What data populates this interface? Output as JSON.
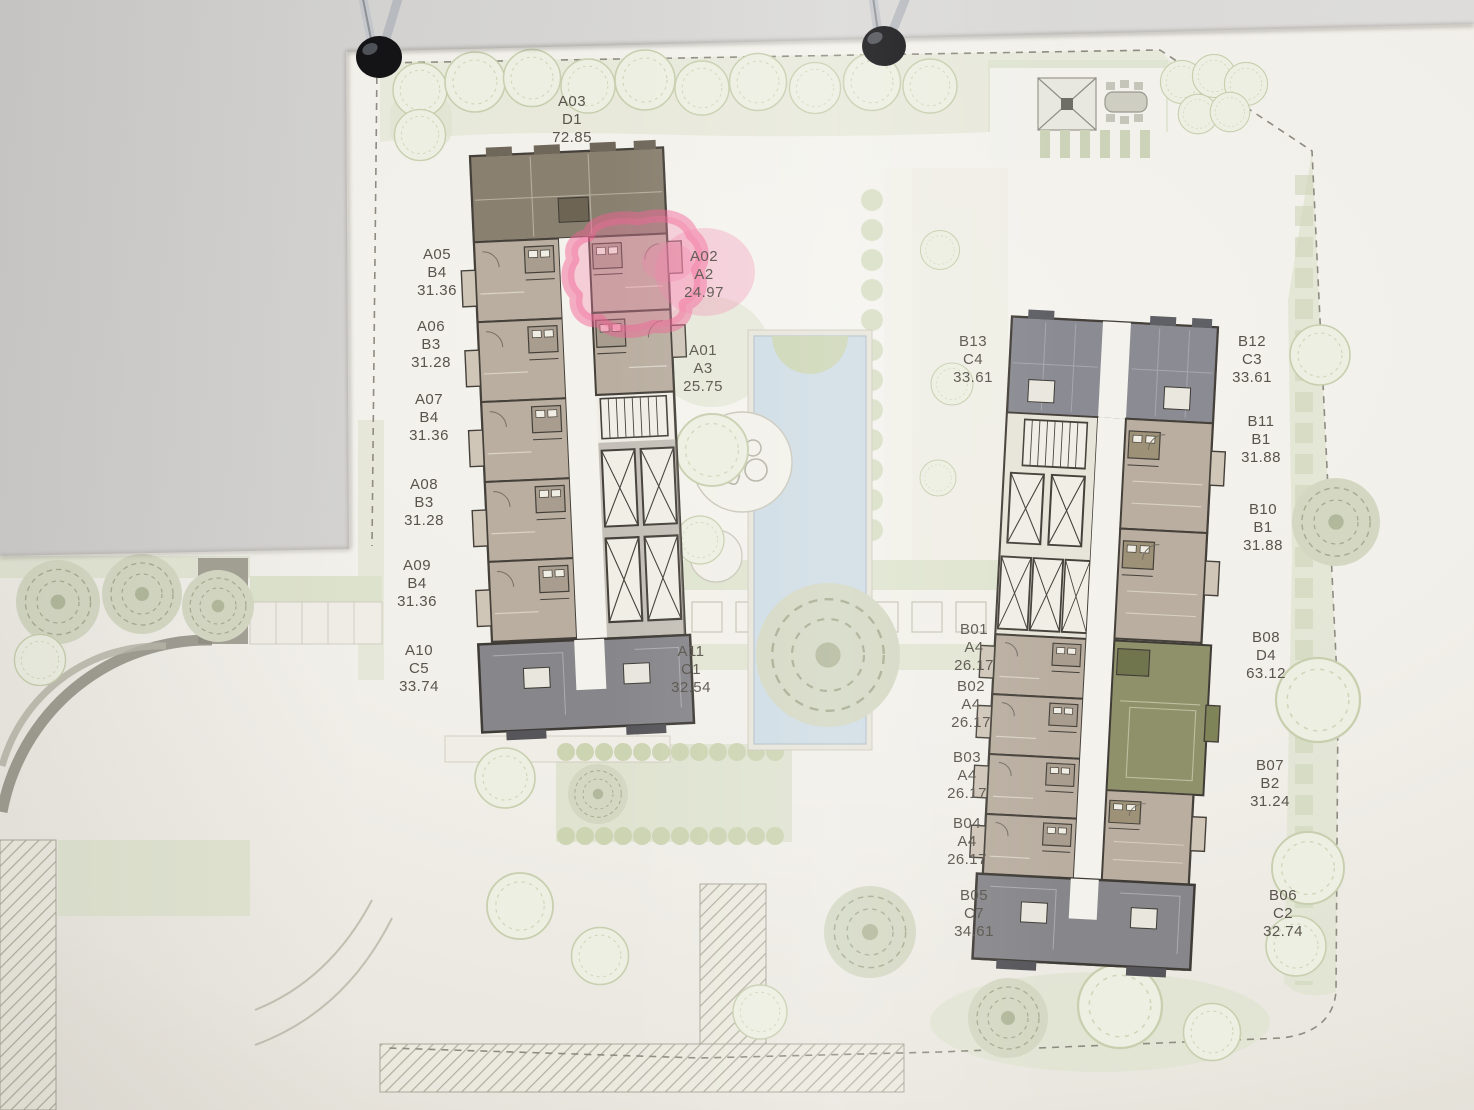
{
  "scene": {
    "binder_clip_count": 2
  },
  "towers": {
    "a": {
      "units": [
        {
          "id": "A03",
          "type": "D1",
          "area": "72.85"
        },
        {
          "id": "A05",
          "type": "B4",
          "area": "31.36"
        },
        {
          "id": "A06",
          "type": "B3",
          "area": "31.28"
        },
        {
          "id": "A07",
          "type": "B4",
          "area": "31.36"
        },
        {
          "id": "A08",
          "type": "B3",
          "area": "31.28"
        },
        {
          "id": "A09",
          "type": "B4",
          "area": "31.36"
        },
        {
          "id": "A10",
          "type": "C5",
          "area": "33.74"
        },
        {
          "id": "A02",
          "type": "A2",
          "area": "24.97",
          "highlighted": true
        },
        {
          "id": "A01",
          "type": "A3",
          "area": "25.75"
        },
        {
          "id": "A11",
          "type": "C1",
          "area": "32.54"
        }
      ]
    },
    "b": {
      "units": [
        {
          "id": "B13",
          "type": "C4",
          "area": "33.61"
        },
        {
          "id": "B12",
          "type": "C3",
          "area": "33.61"
        },
        {
          "id": "B11",
          "type": "B1",
          "area": "31.88"
        },
        {
          "id": "B10",
          "type": "B1",
          "area": "31.88"
        },
        {
          "id": "B01",
          "type": "A4",
          "area": "26.17"
        },
        {
          "id": "B02",
          "type": "A4",
          "area": "26.17"
        },
        {
          "id": "B03",
          "type": "A4",
          "area": "26.17"
        },
        {
          "id": "B04",
          "type": "A4",
          "area": "26.17"
        },
        {
          "id": "B05",
          "type": "C7",
          "area": "34.61"
        },
        {
          "id": "B08",
          "type": "D4",
          "area": "63.12"
        },
        {
          "id": "B07",
          "type": "B2",
          "area": "31.24"
        },
        {
          "id": "B06",
          "type": "C2",
          "area": "32.74"
        }
      ]
    }
  },
  "highlight": {
    "unit": "A02",
    "marker": "hand-drawn pink highlighter"
  },
  "colors": {
    "highlight_marker": "#f2679c",
    "unit_taupe": "#b9aea0",
    "unit_dark": "#87878b",
    "unit_olive": "#8e9169",
    "unit_brown": "#8a8070",
    "pool": "#cfdce4",
    "landscape": "#dfe3d0",
    "paper": "#f1efea",
    "wall": "#d8d7d5",
    "plan_line": "#45413a"
  }
}
